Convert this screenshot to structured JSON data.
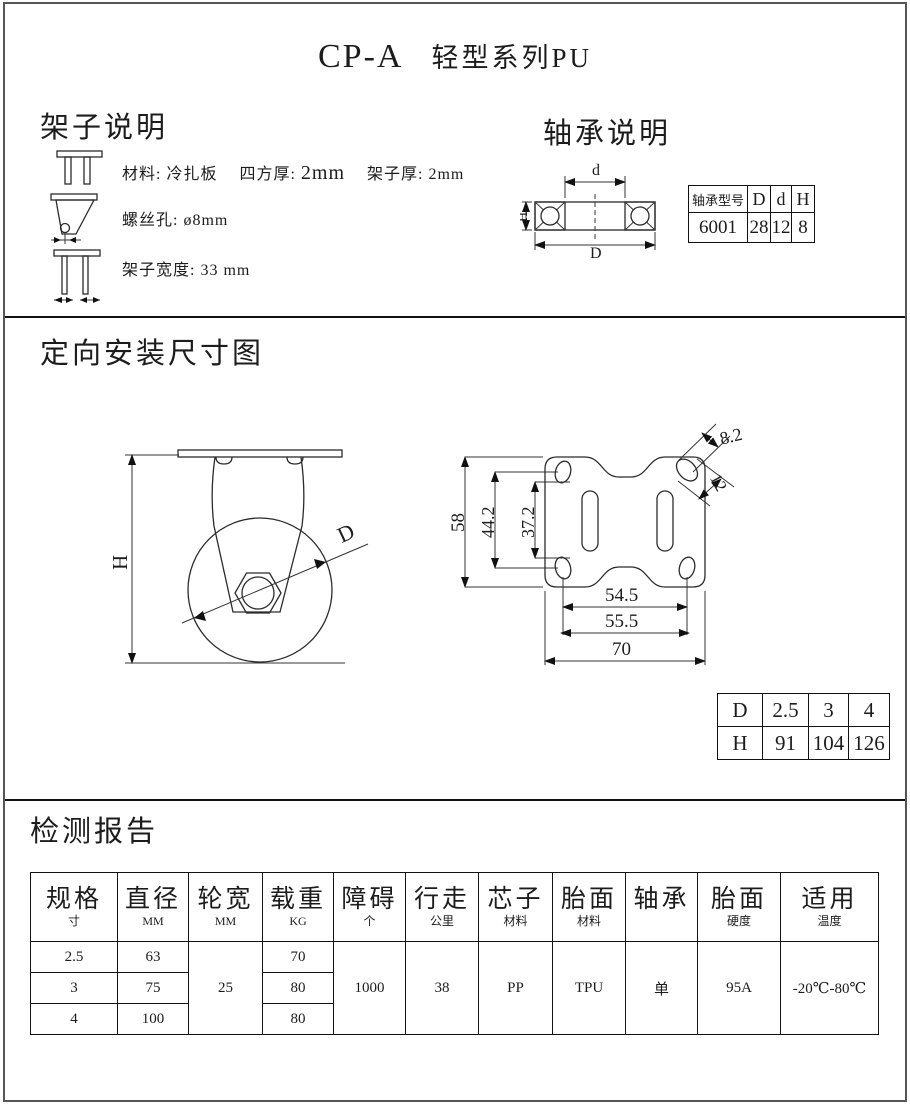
{
  "page": {
    "title_model": "CP-A",
    "title_series": "轻型系列PU"
  },
  "frame_section": {
    "heading": "架子说明",
    "item1": {
      "p1": "材料: 冷扎板",
      "p2_label": "四方厚:",
      "p2_value": "2mm",
      "p3": "架子厚: 2mm"
    },
    "item2": {
      "text": "螺丝孔: ø8mm"
    },
    "item3": {
      "text": "架子宽度: 33 mm"
    }
  },
  "bearing_section": {
    "heading": "轴承说明",
    "diagram": {
      "dim_d": "d",
      "dim_D": "D",
      "dim_H": "H"
    },
    "table": {
      "col1": "轴承型号",
      "col2": "D",
      "col3": "d",
      "col4": "H",
      "val1": "6001",
      "val2": "28",
      "val3": "12",
      "val4": "8"
    }
  },
  "mounting_section": {
    "heading": "定向安装尺寸图",
    "side_view": {
      "dim_H": "H",
      "dim_D": "D"
    },
    "plate_view": {
      "dim_height": "58",
      "dim_bolt_v": "44.2",
      "dim_slot_v": "37.2",
      "dim_bolt_h": "54.5",
      "dim_bolt_h2": "55.5",
      "dim_width": "70",
      "dim_hole_w": "8.2",
      "dim_hole_l": "12"
    },
    "dh_table": {
      "r1c1": "D",
      "r1c2": "2.5",
      "r1c3": "3",
      "r1c4": "4",
      "r2c1": "H",
      "r2c2": "91",
      "r2c3": "104",
      "r2c4": "126"
    }
  },
  "report_section": {
    "heading": "检测报告",
    "table": {
      "headers": [
        {
          "main": "规格",
          "sub": "寸"
        },
        {
          "main": "直径",
          "sub": "MM"
        },
        {
          "main": "轮宽",
          "sub": "MM"
        },
        {
          "main": "载重",
          "sub": "KG"
        },
        {
          "main": "障碍",
          "sub": "个"
        },
        {
          "main": "行走",
          "sub": "公里"
        },
        {
          "main": "芯子",
          "sub": "材料"
        },
        {
          "main": "胎面",
          "sub": "材料"
        },
        {
          "main": "轴承",
          "sub": ""
        },
        {
          "main": "胎面",
          "sub": "硬度"
        },
        {
          "main": "适用",
          "sub": "温度"
        }
      ],
      "rows": [
        {
          "size": "2.5",
          "diameter": "63",
          "load": "70"
        },
        {
          "size": "3",
          "diameter": "75",
          "load": "80"
        },
        {
          "size": "4",
          "diameter": "100",
          "load": "80"
        }
      ],
      "merged": {
        "wheel_width": "25",
        "obstacles": "1000",
        "distance": "38",
        "core_material": "PP",
        "tread_material": "TPU",
        "bearing": "单",
        "tread_hardness": "95A",
        "temperature": "-20℃-80℃"
      }
    }
  }
}
